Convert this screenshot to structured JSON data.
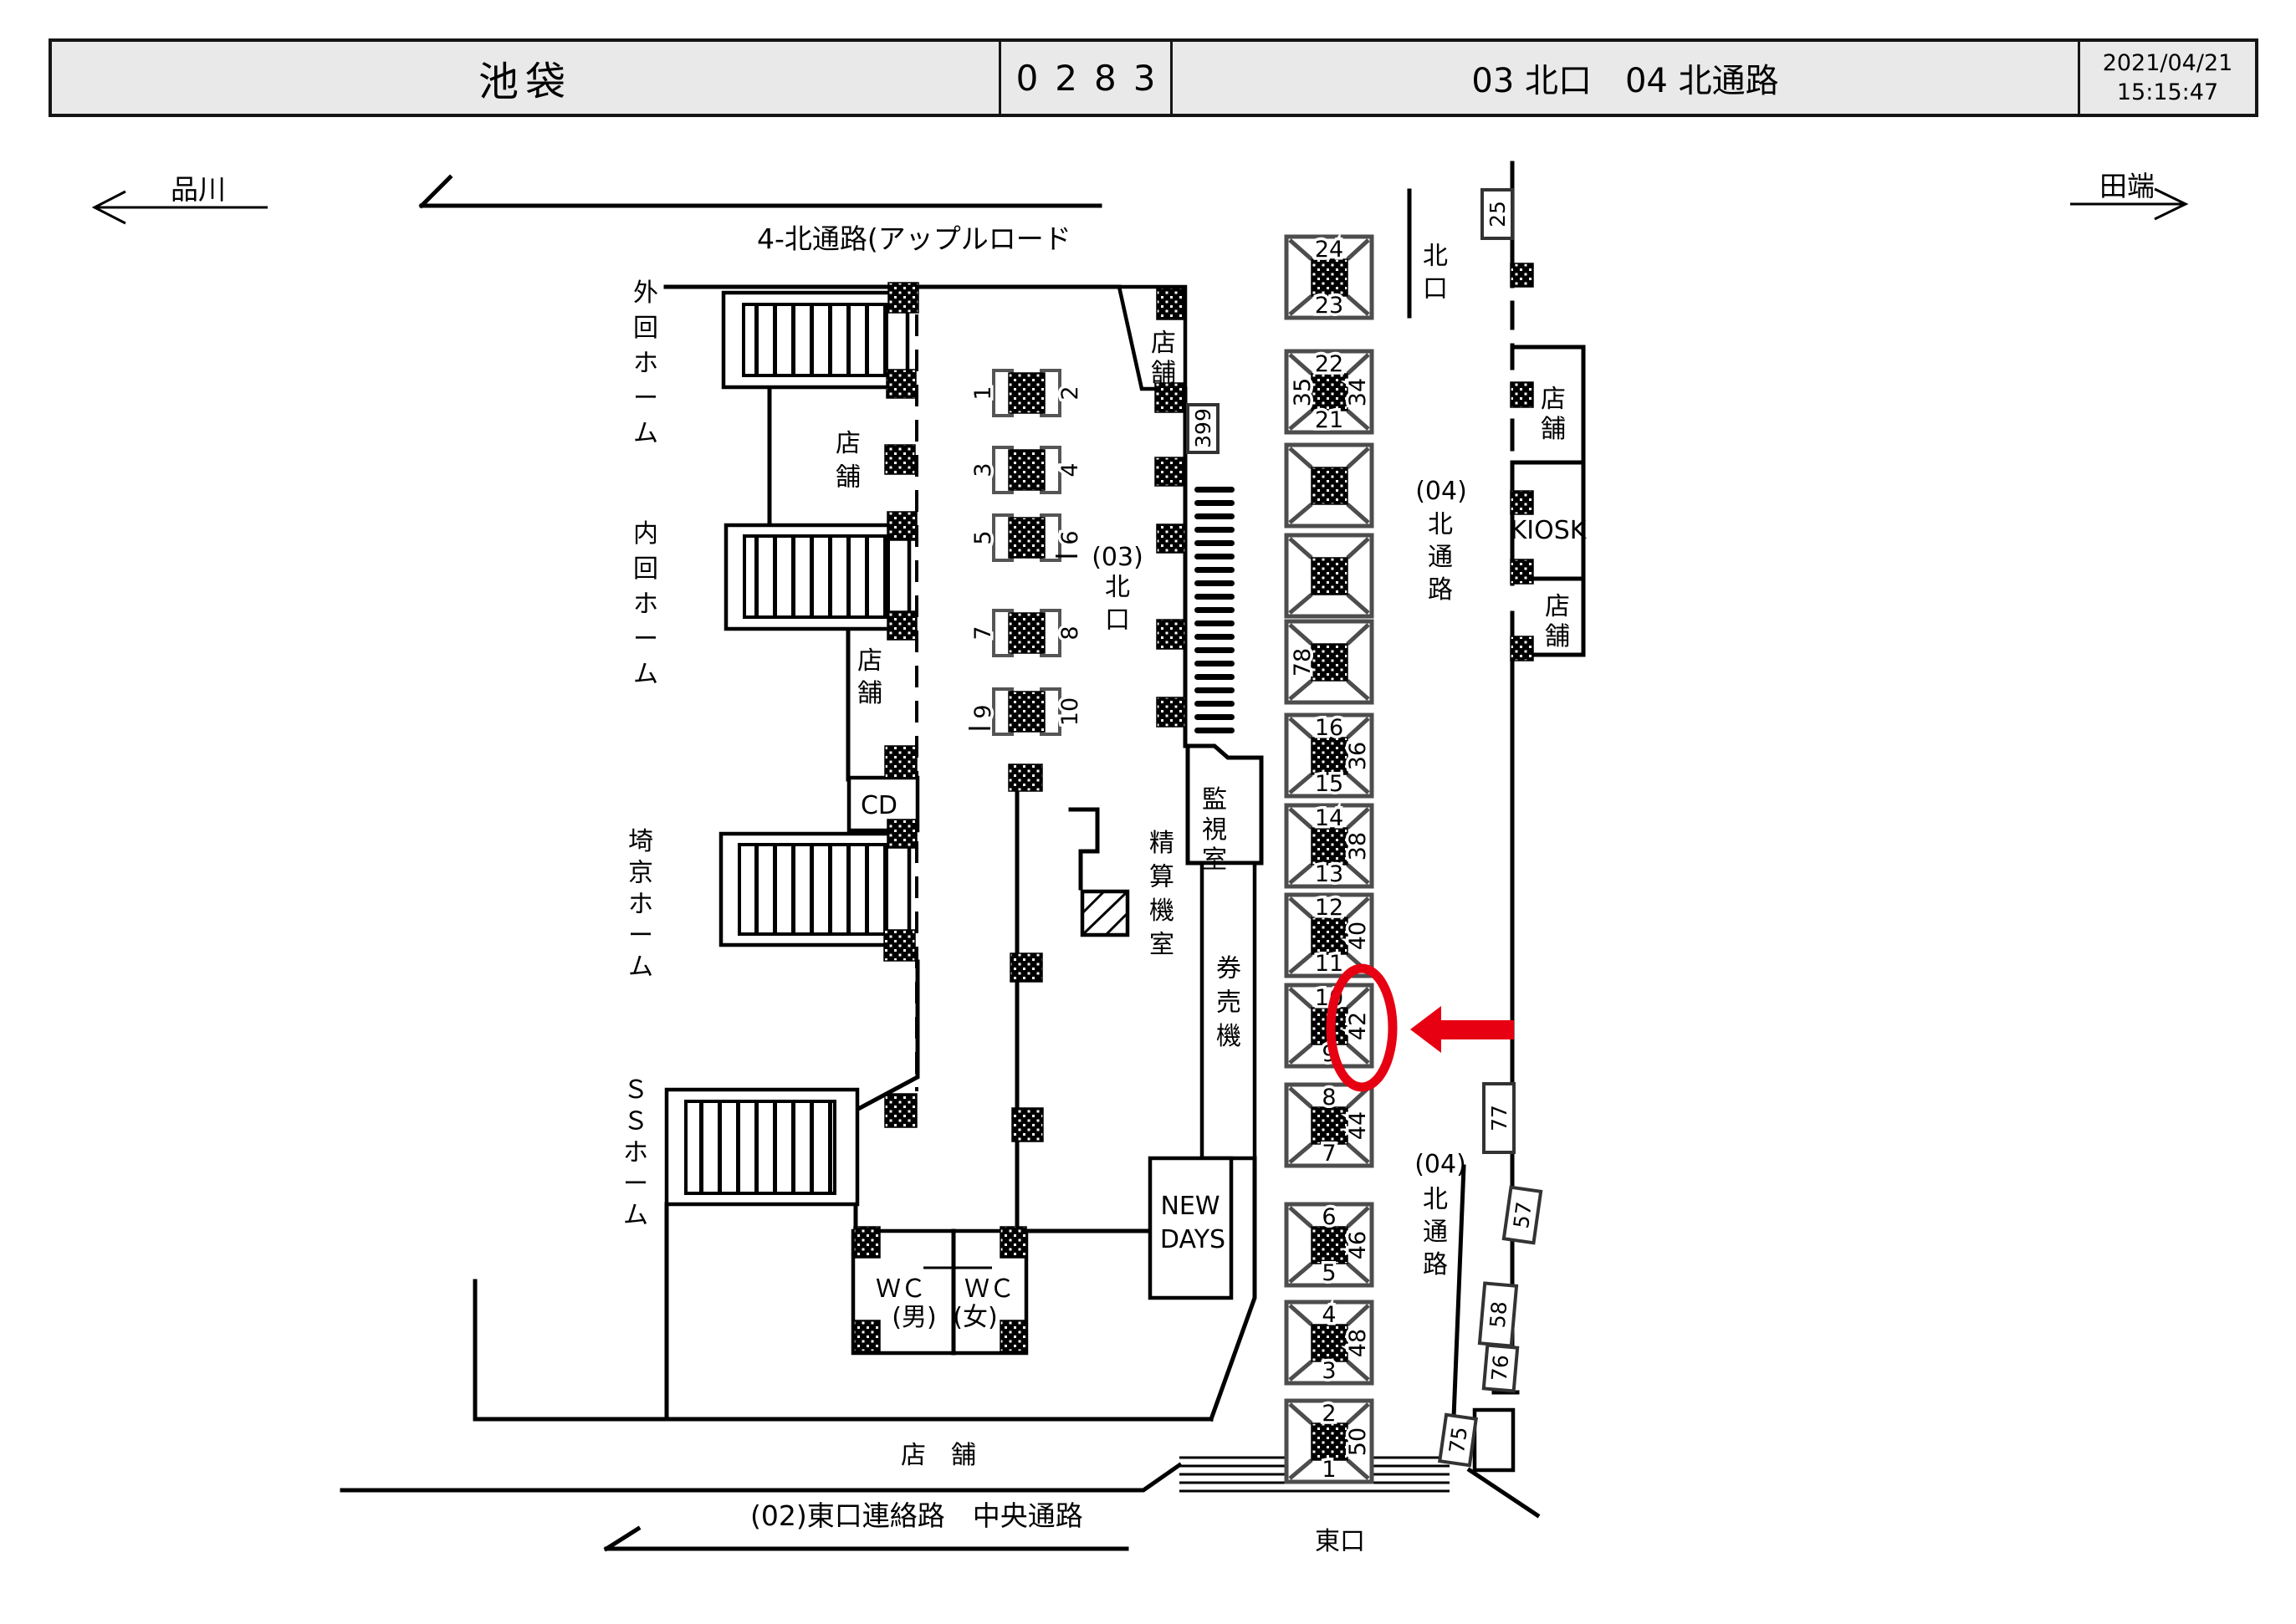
{
  "header": {
    "station": "池袋",
    "code": "0283",
    "location": "03 北口　04 北通路",
    "date": "2021/04/21",
    "time": "15:15:47"
  },
  "directions": {
    "left": "品川",
    "right": "田端"
  },
  "arrows": {
    "top_label": "4-北通路(アップルロード",
    "bottom_label": "(02)東口連絡路　中央通路"
  },
  "platforms": [
    "外回ホーム",
    "内回ホーム",
    "埼京ホーム",
    "ＳＳホーム"
  ],
  "gates": {
    "prefix03": "(03)",
    "prefix04": "(04)",
    "north": "北口",
    "north_passage": "北通路",
    "east": "東口"
  },
  "rooms": {
    "kanshi": "監視室",
    "seisanki": "精算機室",
    "kenbaiki": "券売機",
    "newdays1": "NEW",
    "newdays2": "DAYS",
    "kiosk": "KIOSK",
    "cd": "CD",
    "tenpo": "店舗",
    "tenpo_band": "店　舗",
    "wc": "ＷＣ",
    "wc_male": "(男)",
    "wc_female": "(女)"
  },
  "pillar_pairs": [
    {
      "left": "1",
      "right": "2"
    },
    {
      "left": "3",
      "right": "4"
    },
    {
      "left": "5",
      "right": "6"
    },
    {
      "left": "7",
      "right": "8"
    },
    {
      "left": "9",
      "right": "10"
    }
  ],
  "ad_pillars": [
    {
      "top": "24",
      "bottom": "23"
    },
    {
      "top": "22",
      "bottom": "21",
      "left": "35",
      "right": "34"
    },
    {},
    {},
    {
      "left": "78"
    },
    {
      "top": "16",
      "bottom": "15",
      "right": "36"
    },
    {
      "top": "14",
      "bottom": "13",
      "right": "38"
    },
    {
      "top": "12",
      "bottom": "11",
      "right": "40"
    },
    {
      "top": "10",
      "bottom": "9",
      "right": "42"
    },
    {
      "top": "8",
      "bottom": "7",
      "right": "44"
    },
    {
      "top": "6",
      "bottom": "5",
      "right": "46"
    },
    {
      "top": "4",
      "bottom": "3",
      "right": "48"
    },
    {
      "top": "2",
      "bottom": "1",
      "right": "50"
    }
  ],
  "wall_signs": {
    "s399": "399",
    "s25": "25",
    "s77": "77",
    "s57": "57",
    "s58": "58",
    "s76": "76",
    "s75": "75"
  },
  "highlight": {
    "color": "#e60012"
  }
}
